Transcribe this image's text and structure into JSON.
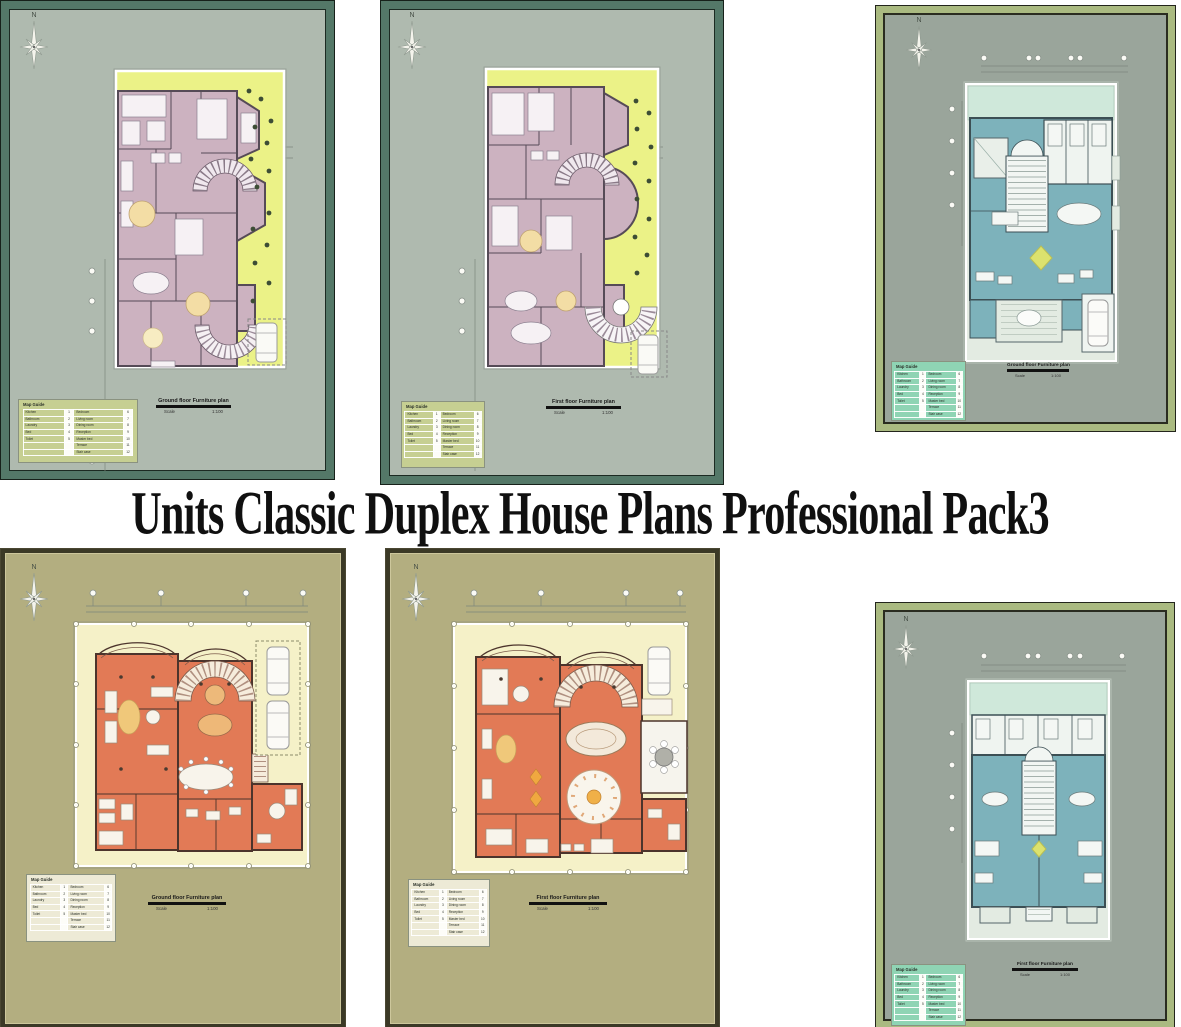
{
  "title": "Units Classic Duplex House Plans Professional Pack3",
  "compass_label": "N",
  "legend": {
    "title": "Map Guide",
    "rows": [
      {
        "l": "Kitchen",
        "ln": "1",
        "r": "Bedroom",
        "rn": "6"
      },
      {
        "l": "Bathroom",
        "ln": "2",
        "r": "Living room",
        "rn": "7"
      },
      {
        "l": "Laundry",
        "ln": "3",
        "r": "Dining room",
        "rn": "8"
      },
      {
        "l": "Bed",
        "ln": "4",
        "r": "Reception",
        "rn": "9"
      },
      {
        "l": "Toilet",
        "ln": "5",
        "r": "Master bed",
        "rn": "10"
      },
      {
        "l": "",
        "ln": "",
        "r": "Terrace",
        "rn": "11"
      },
      {
        "l": "",
        "ln": "",
        "r": "Stair case",
        "rn": "12"
      }
    ]
  },
  "plans": [
    {
      "name": "top-left",
      "caption": "Ground floor Furniture plan",
      "scale_label": "Scale",
      "scale_value": "1:100"
    },
    {
      "name": "top-middle",
      "caption": "First floor Furniture plan",
      "scale_label": "Scale",
      "scale_value": "1:100"
    },
    {
      "name": "top-right",
      "caption": "Ground floor Furniture plan",
      "scale_label": "Scale",
      "scale_value": "1:100"
    },
    {
      "name": "bottom-left",
      "caption": "Ground floor Furniture plan",
      "scale_label": "Scale",
      "scale_value": "1:100"
    },
    {
      "name": "bottom-middle",
      "caption": "First floor Furniture plan",
      "scale_label": "Scale",
      "scale_value": "1:100"
    },
    {
      "name": "bottom-right",
      "caption": "First floor Furniture plan",
      "scale_label": "Scale",
      "scale_value": "1:100"
    }
  ],
  "colors": {
    "title_color": "#101010",
    "title_bg": "#ffffff",
    "green_frame": "#547868",
    "sage_sheet": "#afbaaf",
    "chartreuse_lot": "#ebf287",
    "mauve_rooms": "#ccb2c0",
    "olive_frame": "#aaba81",
    "gray_sheet": "#9aa59b",
    "mint_lot": "#cfe8da",
    "teal_rooms": "#7db2bb",
    "khaki_frame": "#3b3926",
    "khaki_sheet": "#b3ae80",
    "pale_yellow_lot": "#f5f1c8",
    "orange_rooms": "#e27a56",
    "legend_olive": "#c6cf92",
    "legend_mint": "#8fd4b4",
    "legend_cream": "#edead6"
  }
}
